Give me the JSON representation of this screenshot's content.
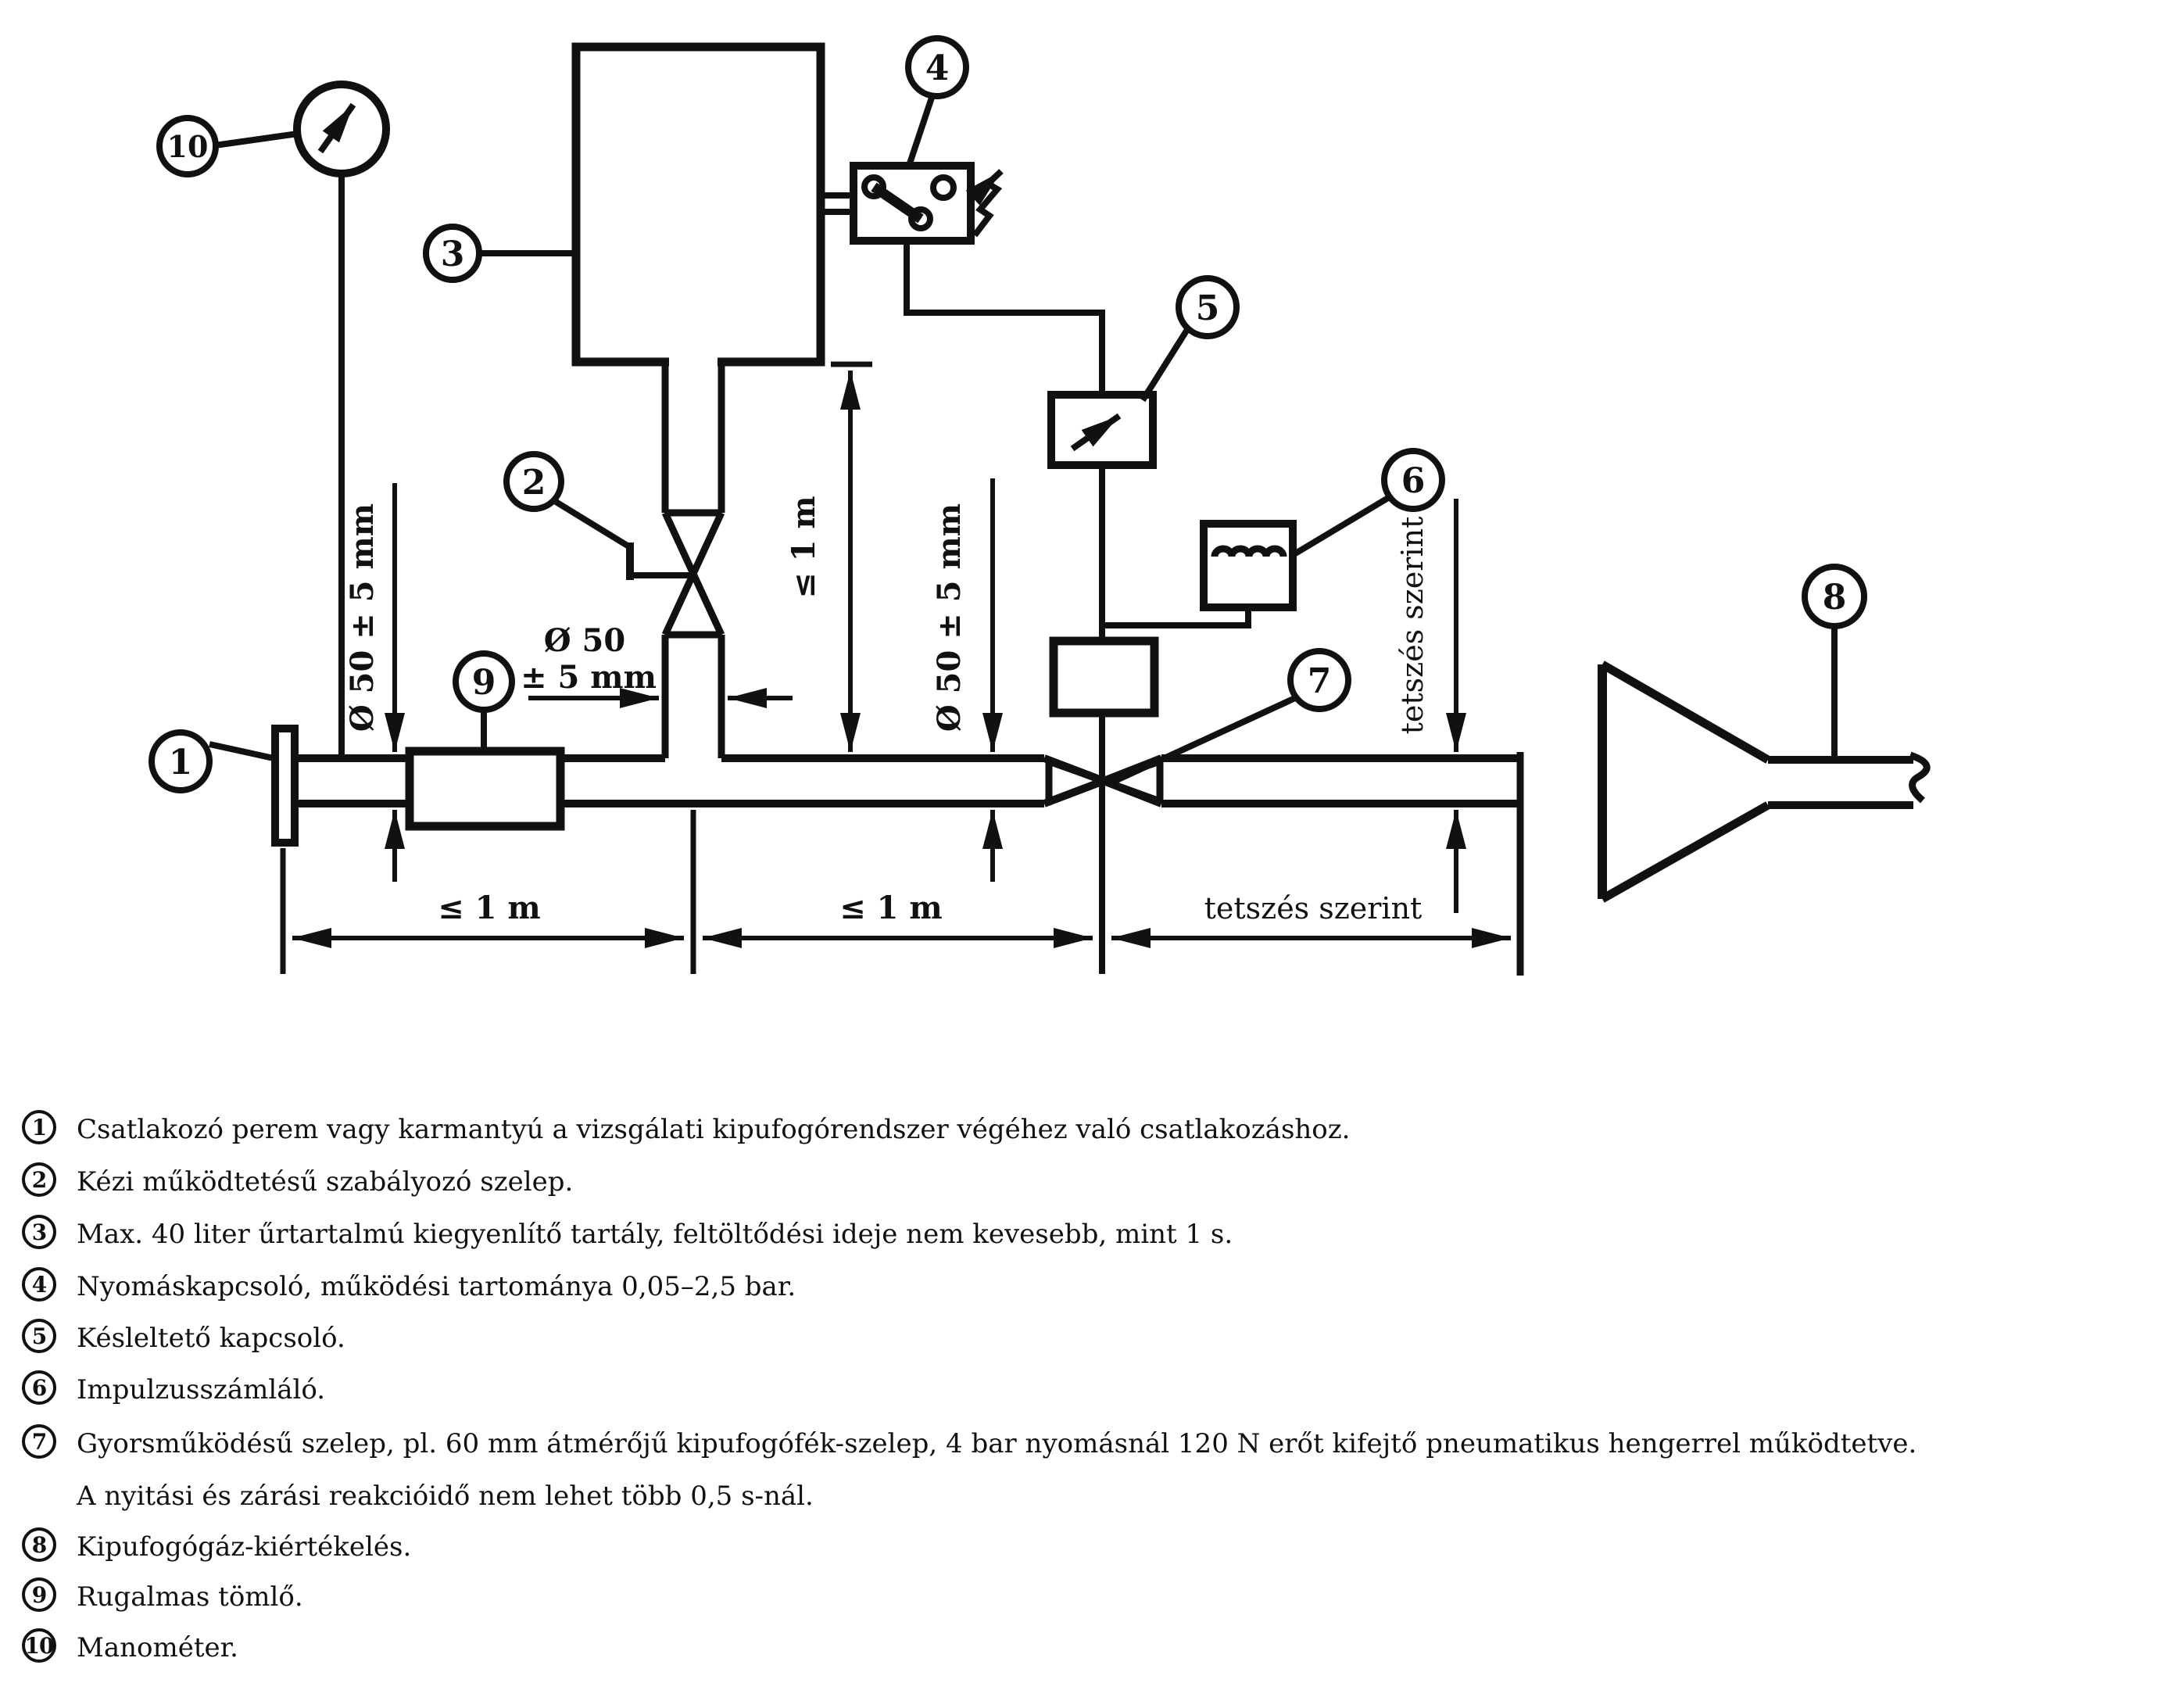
{
  "diagram": {
    "callouts": {
      "c1": "1",
      "c2": "2",
      "c3": "3",
      "c4": "4",
      "c5": "5",
      "c6": "6",
      "c7": "7",
      "c8": "8",
      "c9": "9",
      "c10": "10"
    },
    "dims": {
      "dia_left_vertical": "Ø 50 ± 5 mm",
      "dia_branch_line1": "Ø 50",
      "dia_branch_line2": "± 5 mm",
      "height_vertical": "≤ 1 m",
      "dia_right_vertical": "Ø 50 ± 5 mm",
      "any_vertical": "tetszés szerint",
      "span1": "≤ 1 m",
      "span2": "≤ 1 m",
      "span3": "tetszés szerint"
    }
  },
  "legend": {
    "items": [
      {
        "num": "1",
        "text": "Csatlakozó perem vagy karmantyú a vizsgálati kipufogórendszer végéhez való csatlakozáshoz."
      },
      {
        "num": "2",
        "text": "Kézi működtetésű szabályozó szelep."
      },
      {
        "num": "3",
        "text": "Max. 40 liter űrtartalmú kiegyenlítő tartály, feltöltődési ideje nem kevesebb, mint 1 s."
      },
      {
        "num": "4",
        "text": "Nyomáskapcsoló, működési tartománya 0,05–2,5 bar."
      },
      {
        "num": "5",
        "text": "Késleltető kapcsoló."
      },
      {
        "num": "6",
        "text": "Impulzusszámláló."
      },
      {
        "num": "7",
        "text": "Gyorsműködésű szelep, pl. 60 mm átmérőjű kipufogófék-szelep, 4 bar nyomásnál 120 N erőt kifejtő pneumatikus hengerrel működtetve.",
        "text2": "A nyitási és zárási reakcióidő nem lehet több 0,5 s-nál."
      },
      {
        "num": "8",
        "text": "Kipufogógáz-kiértékelés."
      },
      {
        "num": "9",
        "text": "Rugalmas tömlő."
      },
      {
        "num": "10",
        "text": "Manométer."
      }
    ]
  }
}
